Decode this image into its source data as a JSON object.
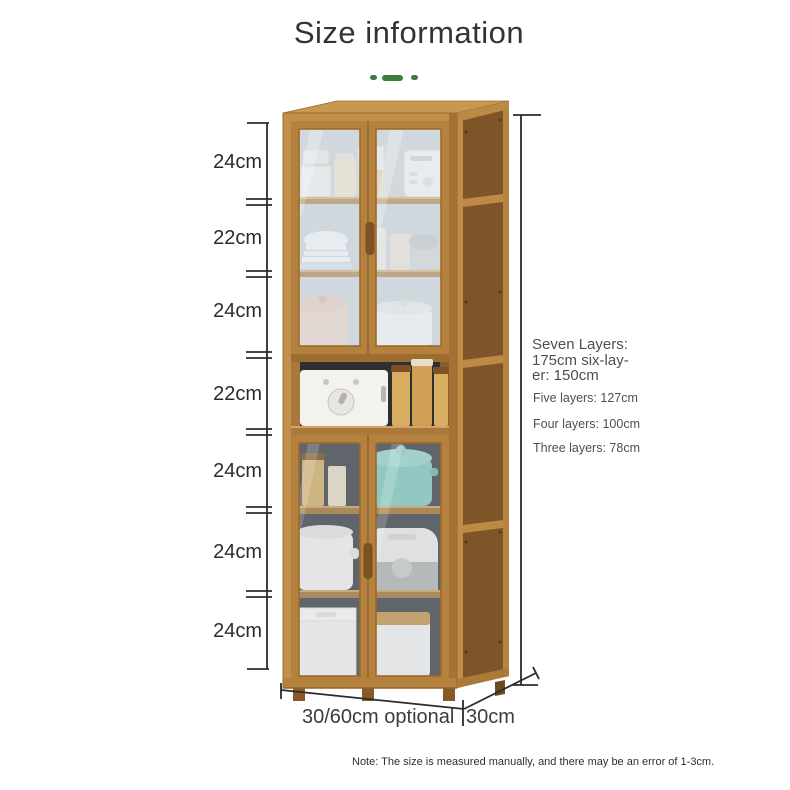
{
  "title": "Size information",
  "colors": {
    "accent_green": "#3e7d3e",
    "dimension_line": "#2b2b2b",
    "wood_front": "#b5813e",
    "wood_light": "#c89851",
    "wood_side": "#7d5528",
    "text_dark": "#303030",
    "text_gray": "#4f4f4f"
  },
  "left_dimensions": [
    "24cm",
    "22cm",
    "24cm",
    "22cm",
    "24cm",
    "24cm",
    "24cm"
  ],
  "height_info": {
    "primary_lines": [
      "Seven Layers:",
      "175cm six-lay-",
      "er: 150cm"
    ],
    "secondary_lines": [
      "Five layers: 127cm",
      "Four layers: 100cm",
      "Three layers: 78cm"
    ]
  },
  "bottom_dimensions": {
    "width_label": "30/60cm optional",
    "depth_label": "30cm"
  },
  "note": "Note: The size is measured manually, and there may be an error of 1-3cm."
}
